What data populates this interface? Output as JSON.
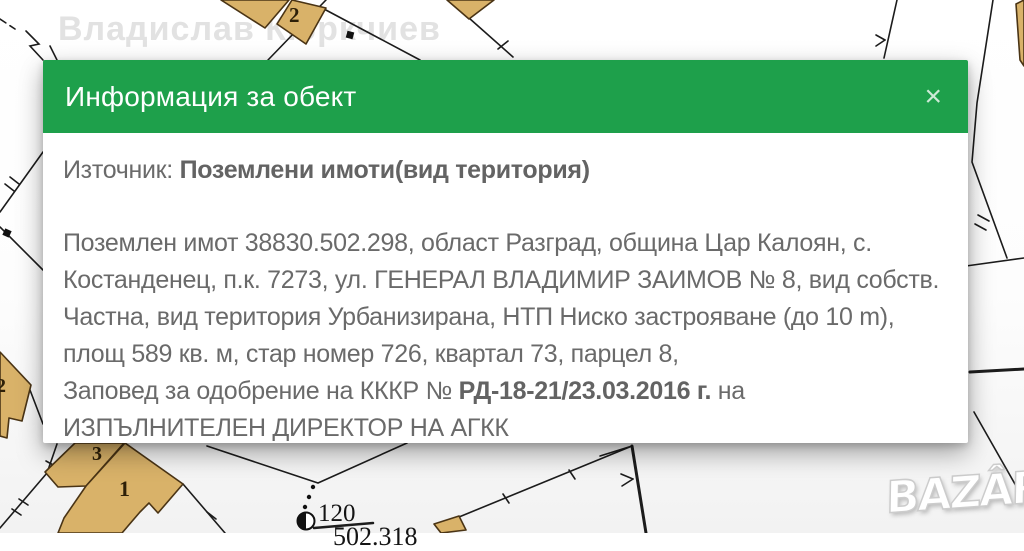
{
  "watermark": "Владислав Кюркчиев",
  "logo": "BAZÂR",
  "modal": {
    "title": "Информация за обект",
    "close_label": "×",
    "source_label": "Източник:",
    "source_value": "Поземлени имоти(вид територия)",
    "description_lines": [
      "Поземлен имот 38830.502.298, област Разград, община Цар Калоян, с.",
      "Костанденец, п.к. 7273, ул. ГЕНЕРАЛ ВЛАДИМИР ЗАИМОВ № 8, вид собств.",
      "Частна, вид територия Урбанизирана, НТП Ниско застрояване (до 10 m),",
      "площ 589 кв. м, стар номер 726, квартал 73, парцел 8,"
    ],
    "order_prefix": "Заповед за одобрение на КККР № ",
    "order_number": "РД-18-21/23.03.2016 г.",
    "order_suffix": " на",
    "order_line2": "ИЗПЪЛНИТЕЛЕН ДИРЕКТОР НА АГКК"
  },
  "map": {
    "labels": {
      "parcel_top": "2",
      "parcel_left": "2",
      "building_3": "3",
      "building_1": "1",
      "survey_point": "120",
      "parcel_bottom": "502.318"
    },
    "colors": {
      "header_green": "#1ea04b",
      "parcel_fill": "#d9b269",
      "parcel_stroke": "#4a3415",
      "map_line": "#1c1c1c",
      "body_text": "#6a6a6a",
      "watermark": "#e2e2e2"
    }
  }
}
